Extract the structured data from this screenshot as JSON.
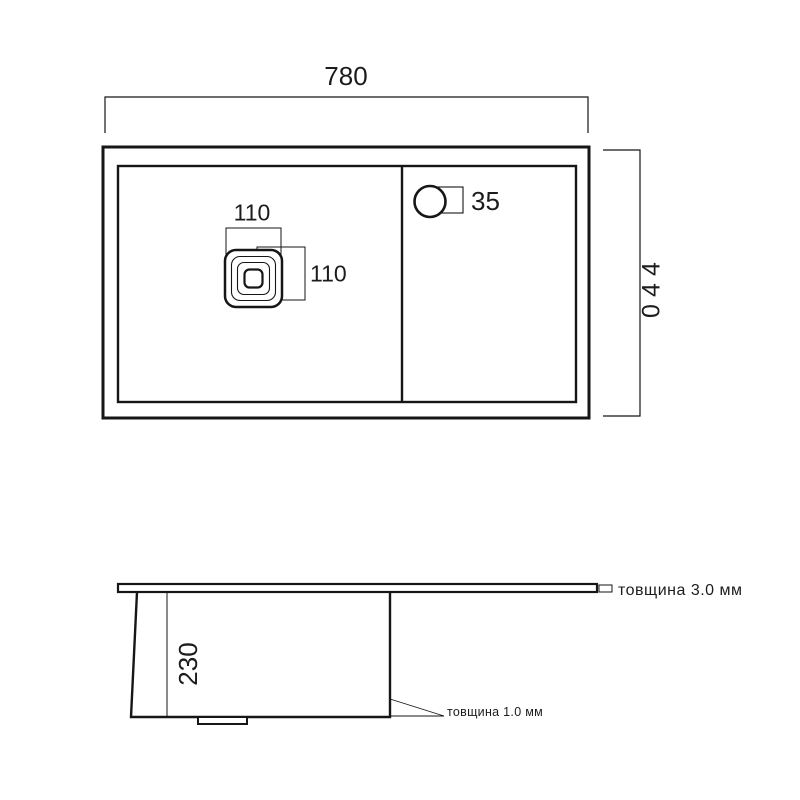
{
  "drawing": {
    "top_view": {
      "width_mm": "780",
      "height_mm": "440",
      "drain_width_mm": "110",
      "drain_height_mm": "110",
      "faucet_hole_mm": "35"
    },
    "side_view": {
      "bowl_depth_mm": "230",
      "rim_thickness_note": "товщина 3.0 мм",
      "wall_thickness_note": "товщина 1.0 мм"
    },
    "colors": {
      "line": "#161616",
      "background": "#ffffff"
    }
  }
}
